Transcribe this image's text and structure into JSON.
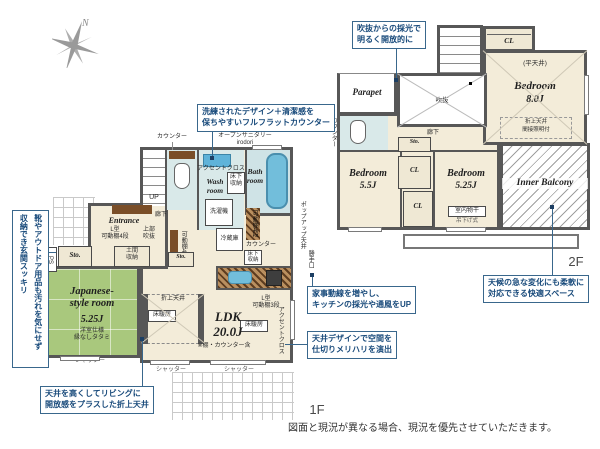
{
  "compass": {
    "north": "N"
  },
  "floor1": {
    "floor_label": "1F",
    "rooms": {
      "entrance": "Entrance",
      "jp_name": "Japanese-\nstyle room",
      "jp_size": "5.25J",
      "jp_note": "洋室仕様\n縁なしタタミ",
      "ldk_name": "LDK\n20.0J",
      "ldk_note": "※棚・カウンター含",
      "wash": "Wash\nroom",
      "bath": "Bath\nroom",
      "sto": "Sto.",
      "ps": "PS"
    },
    "labels": {
      "counter": "カウンター",
      "open_sanitary": "オープンサニタリー\nirodori",
      "accent_cloth": "アクセントクロス",
      "underfloor": "床下\n収納",
      "washer": "洗濯機",
      "up": "UP",
      "hall": "廊下",
      "l_shelf4": "L型\n可動棚4段",
      "upper_void": "上部\n吹抜",
      "doma": "土間\n収納",
      "shelf4": "可動棚4段",
      "fridge": "冷蔵庫",
      "l_shelf3": "L型\n可動棚3段",
      "oriage": "折上天井",
      "yukadan": "床暖房",
      "accent_v": "アクセントクロス",
      "popup": "ポップアップ天井",
      "backdoor": "勝手口",
      "shutter": "シャッター"
    },
    "callouts": {
      "flat_counter": "洗練されたデザイン＋清潔感を\n保ちやすいフルフラットカウンター",
      "genkan": "靴やアウトドア用品も汚れを気にせず\n収納でき玄関スッキリ",
      "oriage": "天井を高くしてリビングに\n開放感をプラスした折上天井",
      "kaji": "家事動線を増やし、\nキッチンの採光や通風をUP",
      "ceiling_design": "天井デザインで空間を\n仕切りメリハリを演出"
    }
  },
  "floor2": {
    "floor_label": "2F",
    "rooms": {
      "bed8_name": "Bedroom",
      "bed8_size": "8.0J",
      "bed8_ceiling": "(平天井)",
      "bed8_note": "折上天井\n間接照明付",
      "bed55_name": "Bedroom",
      "bed55_size": "5.5J",
      "bed525_name": "Bedroom",
      "bed525_size": "5.25J",
      "monohoshi": "室内物干",
      "monohoshi_sub": "吊下げ式",
      "balcony": "Inner Balcony",
      "parapet": "Parapet",
      "void": "吹抜",
      "cl": "CL",
      "sto": "Sto."
    },
    "labels": {
      "dn": "DN",
      "hall": "廊下",
      "counter_v": "カウンター"
    },
    "callouts": {
      "void_light": "吹抜からの採光で\n明るく開放的に",
      "weather": "天候の急な変化にも柔軟に\n対応できる快適スペース"
    }
  },
  "footer": {
    "disclaimer": "図面と現況が異なる場合、現況を優先させていただきます。"
  }
}
